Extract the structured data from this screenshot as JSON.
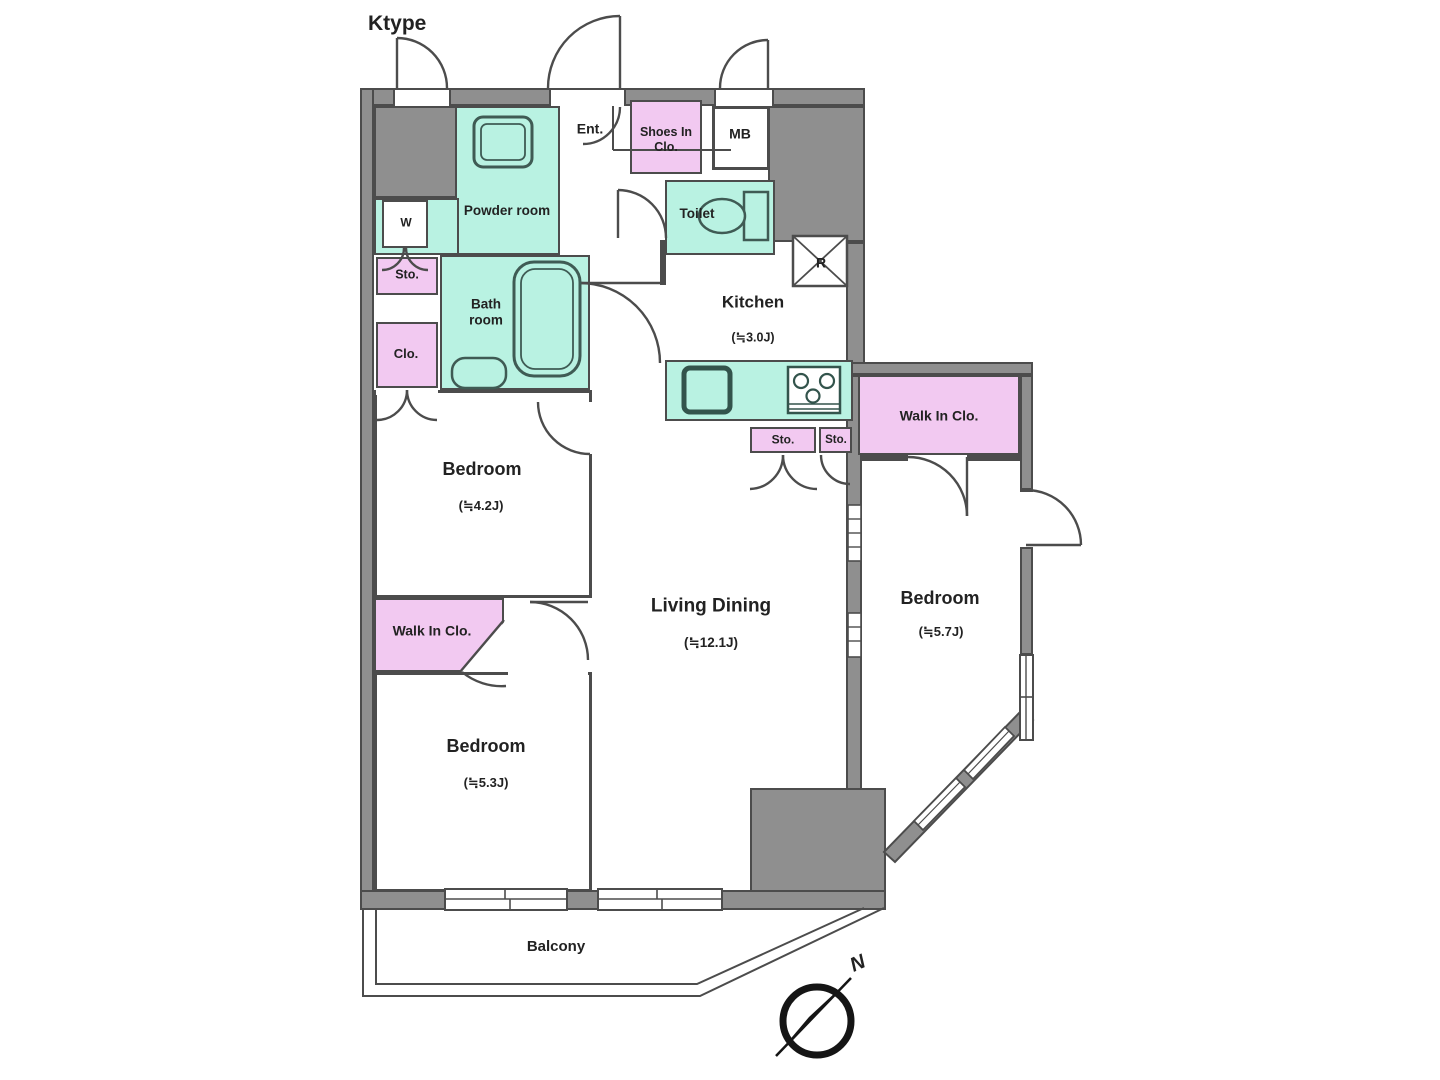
{
  "title": "Ktype",
  "colors": {
    "wall_fill": "#8f8f8f",
    "wall_line": "#4c4c4c",
    "room_teal": "#b9f2e2",
    "room_pink": "#f2c9f1",
    "text": "#222222"
  },
  "rooms": {
    "powder": {
      "label": "Powder room"
    },
    "washer": {
      "label": "W"
    },
    "storage_left": {
      "label": "Sto."
    },
    "closet_left": {
      "label": "Clo."
    },
    "bathroom": {
      "label": "Bath room"
    },
    "entrance": {
      "label": "Ent."
    },
    "shoes_closet": {
      "label": "Shoes In Clo."
    },
    "meter_box": {
      "label": "MB"
    },
    "toilet": {
      "label": "Toilet"
    },
    "refrigerator": {
      "label": "R"
    },
    "kitchen": {
      "label": "Kitchen",
      "size": "(≒3.0J)"
    },
    "storage_kitchen_1": {
      "label": "Sto."
    },
    "storage_kitchen_2": {
      "label": "Sto."
    },
    "walk_in_closet_right": {
      "label": "Walk In Clo."
    },
    "bedroom_upper_left": {
      "label": "Bedroom",
      "size": "(≒4.2J)"
    },
    "walk_in_closet_left": {
      "label": "Walk In Clo."
    },
    "bedroom_lower_left": {
      "label": "Bedroom",
      "size": "(≒5.3J)"
    },
    "living_dining": {
      "label": "Living Dining",
      "size": "(≒12.1J)"
    },
    "bedroom_right": {
      "label": "Bedroom",
      "size": "(≒5.7J)"
    },
    "balcony": {
      "label": "Balcony"
    }
  },
  "compass": {
    "label": "N"
  }
}
